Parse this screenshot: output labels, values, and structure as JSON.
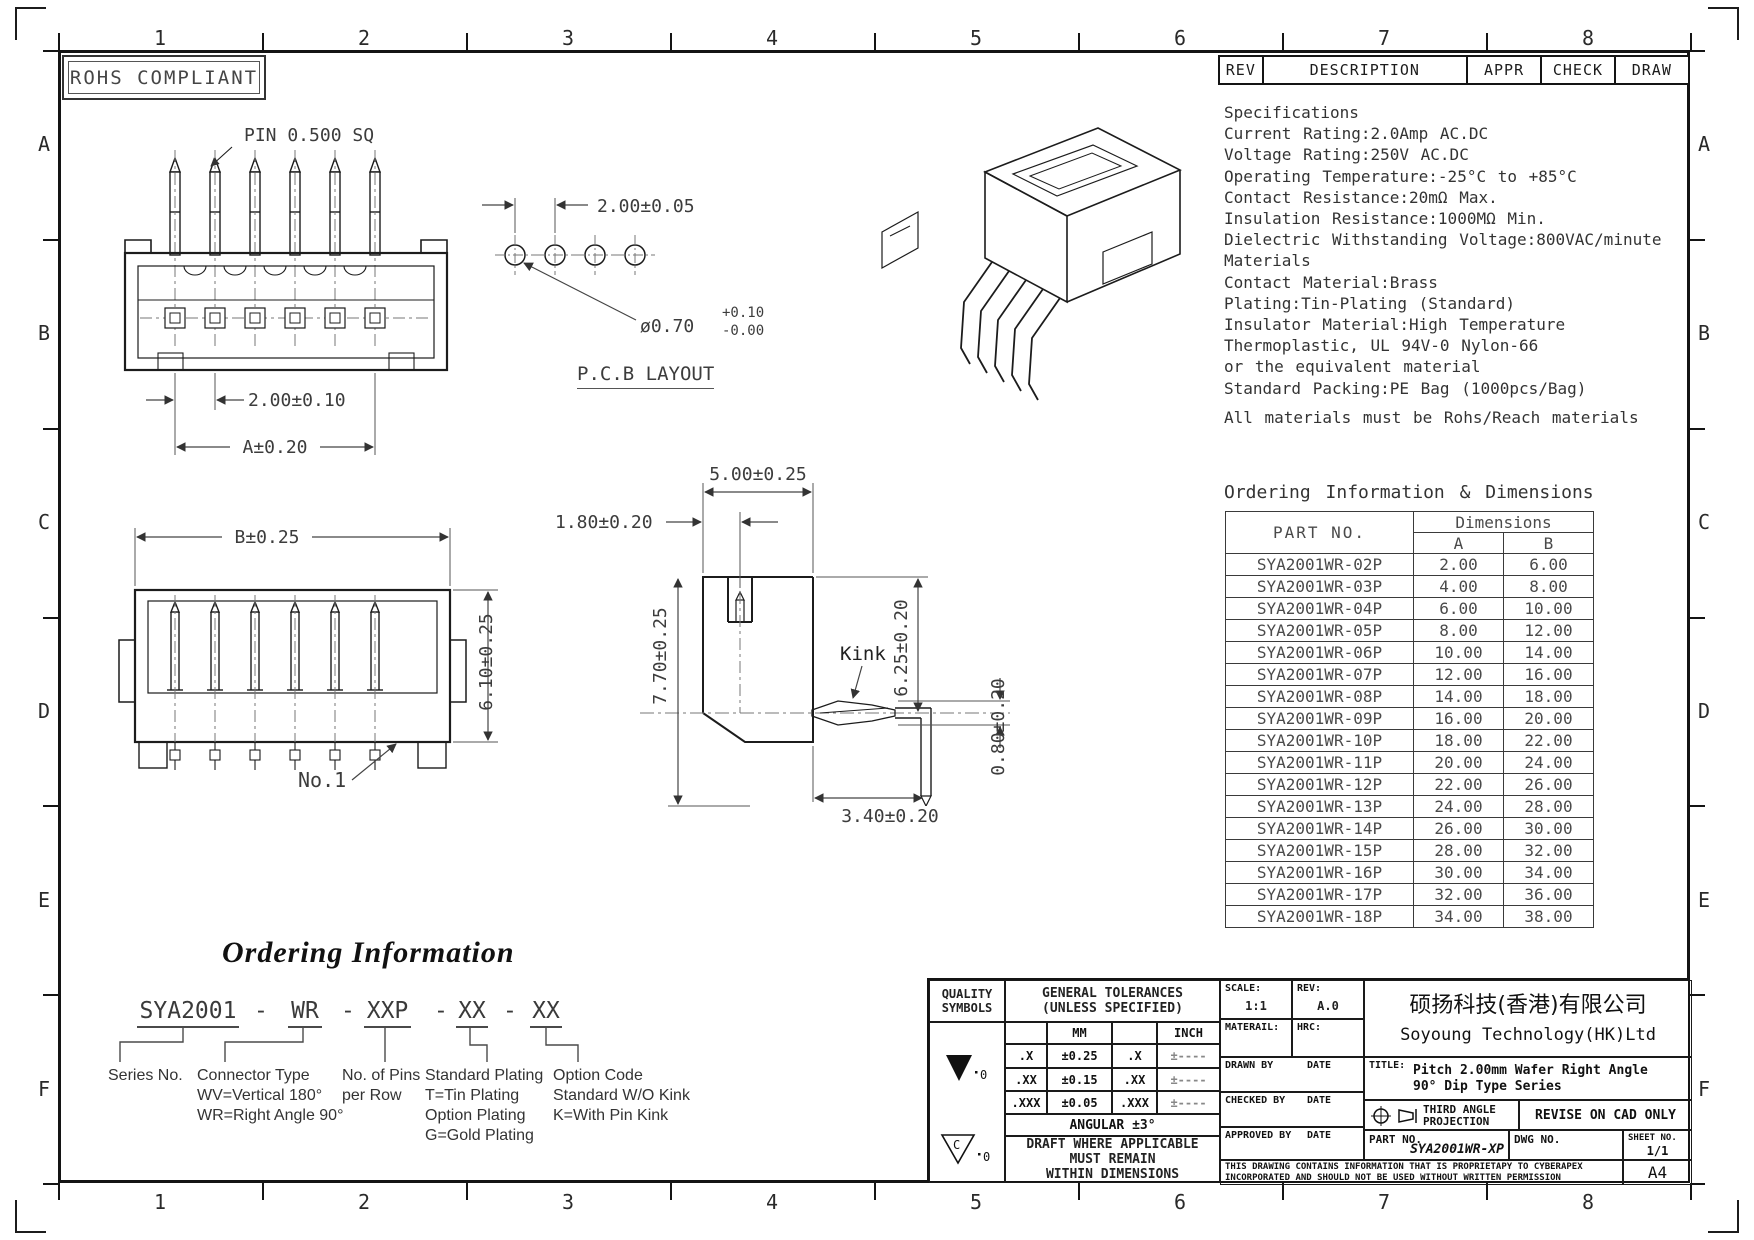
{
  "frame": {
    "cols": [
      "1",
      "2",
      "3",
      "4",
      "5",
      "6",
      "7",
      "8"
    ],
    "rows": [
      "A",
      "B",
      "C",
      "D",
      "E",
      "F"
    ]
  },
  "badge": {
    "text": "ROHS COMPLIANT"
  },
  "rev_bar": {
    "rev": "REV",
    "description": "DESCRIPTION",
    "appr": "APPR",
    "check": "CHECK",
    "draw": "DRAW"
  },
  "specifications": {
    "title": "Specifications",
    "lines": [
      "Current Rating:2.0Amp AC.DC",
      "Voltage Rating:250V AC.DC",
      "Operating Temperature:-25°C to +85°C",
      "Contact Resistance:20mΩ Max.",
      "Insulation Resistance:1000MΩ Min.",
      "Dielectric Withstanding Voltage:800VAC/minute",
      "Materials",
      "Contact Material:Brass",
      "Plating:Tin-Plating (Standard)",
      "Insulator Material:High Temperature",
      "Thermoplastic, UL 94V-0 Nylon-66",
      "or the equivalent material",
      "Standard Packing:PE Bag (1000pcs/Bag)",
      "All materials must be Rohs/Reach materials"
    ]
  },
  "ordering_table": {
    "title": "Ordering Information & Dimensions",
    "part_col": "PART NO.",
    "dim_col": "Dimensions",
    "col_a": "A",
    "col_b": "B",
    "rows": [
      {
        "part": "SYA2001WR-02P",
        "a": "2.00",
        "b": "6.00"
      },
      {
        "part": "SYA2001WR-03P",
        "a": "4.00",
        "b": "8.00"
      },
      {
        "part": "SYA2001WR-04P",
        "a": "6.00",
        "b": "10.00"
      },
      {
        "part": "SYA2001WR-05P",
        "a": "8.00",
        "b": "12.00"
      },
      {
        "part": "SYA2001WR-06P",
        "a": "10.00",
        "b": "14.00"
      },
      {
        "part": "SYA2001WR-07P",
        "a": "12.00",
        "b": "16.00"
      },
      {
        "part": "SYA2001WR-08P",
        "a": "14.00",
        "b": "18.00"
      },
      {
        "part": "SYA2001WR-09P",
        "a": "16.00",
        "b": "20.00"
      },
      {
        "part": "SYA2001WR-10P",
        "a": "18.00",
        "b": "22.00"
      },
      {
        "part": "SYA2001WR-11P",
        "a": "20.00",
        "b": "24.00"
      },
      {
        "part": "SYA2001WR-12P",
        "a": "22.00",
        "b": "26.00"
      },
      {
        "part": "SYA2001WR-13P",
        "a": "24.00",
        "b": "28.00"
      },
      {
        "part": "SYA2001WR-14P",
        "a": "26.00",
        "b": "30.00"
      },
      {
        "part": "SYA2001WR-15P",
        "a": "28.00",
        "b": "32.00"
      },
      {
        "part": "SYA2001WR-16P",
        "a": "30.00",
        "b": "34.00"
      },
      {
        "part": "SYA2001WR-17P",
        "a": "32.00",
        "b": "36.00"
      },
      {
        "part": "SYA2001WR-18P",
        "a": "34.00",
        "b": "38.00"
      }
    ]
  },
  "views": {
    "front": {
      "pin_label": "PIN 0.500 SQ",
      "pitch": "2.00±0.10",
      "overall": "A±0.20"
    },
    "pcb": {
      "pitch": "2.00±0.05",
      "hole": "ø0.70",
      "tol_plus": "+0.10",
      "tol_minus": "-0.00",
      "caption": "P.C.B LAYOUT"
    },
    "rear": {
      "overall": "B±0.25",
      "height": "6.10±0.25",
      "pin1": "No.1"
    },
    "side": {
      "depth": "5.00±0.25",
      "offset": "1.80±0.20",
      "height": "7.70±0.25",
      "body": "6.25±0.20",
      "kink": "Kink",
      "kink_height": "0.80±0.20",
      "tail": "3.40±0.20"
    }
  },
  "ordering_info": {
    "title": "Ordering Information",
    "separator": "-",
    "code_parts": [
      "SYA2001",
      "WR",
      "XXP",
      "XX",
      "XX"
    ],
    "legends": [
      [
        "Series No."
      ],
      [
        "Connector Type",
        "WV=Vertical 180°",
        "WR=Right Angle 90°"
      ],
      [
        "No. of Pins",
        "per Row"
      ],
      [
        "Standard Plating",
        "T=Tin Plating",
        "Option Plating",
        "G=Gold Plating"
      ],
      [
        "Option Code",
        "Standard W/O Kink",
        "K=With Pin Kink"
      ]
    ]
  },
  "title_block": {
    "quality_1": "QUALITY",
    "quality_2": "SYMBOLS",
    "tol_title_1": "GENERAL TOLERANCES",
    "tol_title_2": "(UNLESS SPECIFIED)",
    "mm": "MM",
    "inch": "INCH",
    "tol_rows": [
      [
        ".X",
        "±0.25",
        ".X",
        "±----"
      ],
      [
        ".XX",
        "±0.15",
        ".XX",
        "±----"
      ],
      [
        ".XXX",
        "±0.05",
        ".XXX",
        "±----"
      ]
    ],
    "angular": "ANGULAR ±3°",
    "draft_1": "DRAFT WHERE APPLICABLE",
    "draft_2": "MUST REMAIN",
    "draft_3": "WITHIN DIMENSIONS",
    "sym1_suffix": "0",
    "sym2_letter": "C",
    "sym2_suffix": "0",
    "scale_label": "SCALE:",
    "scale": "1:1",
    "rev_label": "REV:",
    "rev": "A.0",
    "material_label": "MATERAIL:",
    "hrc_label": "HRC:",
    "drawn_label": "DRAWN BY",
    "checked_label": "CHECKED BY",
    "approved_label": "APPROVED BY",
    "date_label": "DATE",
    "company_cn": "硕扬科技(香港)有限公司",
    "company_en": "Soyoung Technology(HK)Ltd",
    "title_label": "TITLE:",
    "title_1": "Pitch 2.00mm Wafer Right Angle",
    "title_2": "90° Dip Type Series",
    "projection_1": "THIRD ANGLE",
    "projection_2": "PROJECTION",
    "revise": "REVISE ON CAD ONLY",
    "part_label": "PART NO.",
    "part_no": "SYA2001WR-XP",
    "dwg_label": "DWG NO.",
    "sheet_label": "SHEET NO.",
    "sheet_no": "1/1",
    "disclaimer_1": "THIS DRAWING CONTAINS INFORMATION THAT IS PROPRIETAPY TO CYBERAPEX",
    "disclaimer_2": "INCORPORATED AND SHOULD NOT BE USED WITHOUT WRITTEN PERMISSION",
    "paper": "A4"
  }
}
